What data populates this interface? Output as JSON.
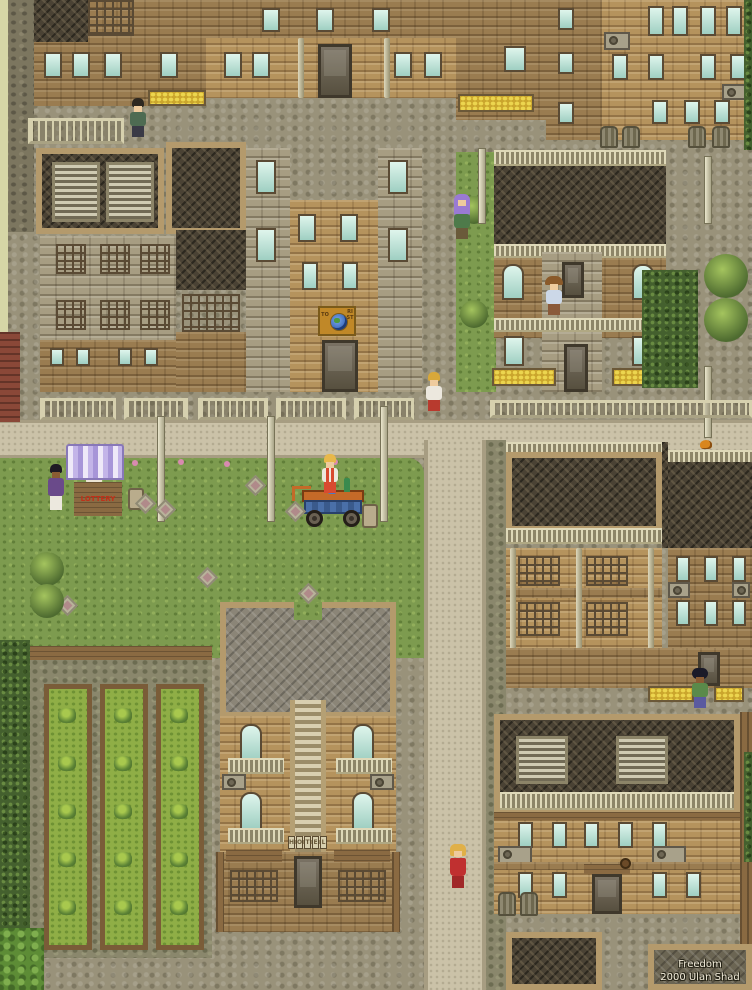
{
  "credits": {
    "line1": "Freedom",
    "line2": "2000 Ulan Shad"
  },
  "signs": {
    "hotel_letters": [
      "H",
      "O",
      "T",
      "E",
      "L"
    ],
    "lottery": "LOTTERY",
    "tourist_left": "TO",
    "tourist_right": "RIST"
  },
  "palette": {
    "cobble": "#99927a",
    "road": "#cbc2a8",
    "grass": "#7d9b4f",
    "brick": "#b5935d",
    "lattice": "#4a4234",
    "window": "#9fcfc2",
    "wood": "#8a6a42",
    "hedge": "#44602e",
    "roofGray": "#8b8577",
    "awning": "#c3b4e8",
    "gold": "#c08828",
    "globe": "#3866b8",
    "red": "#c03018"
  },
  "npcs": [
    {
      "label": "villager by fence"
    },
    {
      "label": "purple-haired woman"
    },
    {
      "label": "man with hat on balcony"
    },
    {
      "label": "woman walking on sidewalk"
    },
    {
      "label": "customer at lottery stall"
    },
    {
      "label": "lottery stall vendor"
    },
    {
      "label": "street cart vendor"
    },
    {
      "label": "villager in alley"
    },
    {
      "label": "woman in red dress"
    }
  ]
}
